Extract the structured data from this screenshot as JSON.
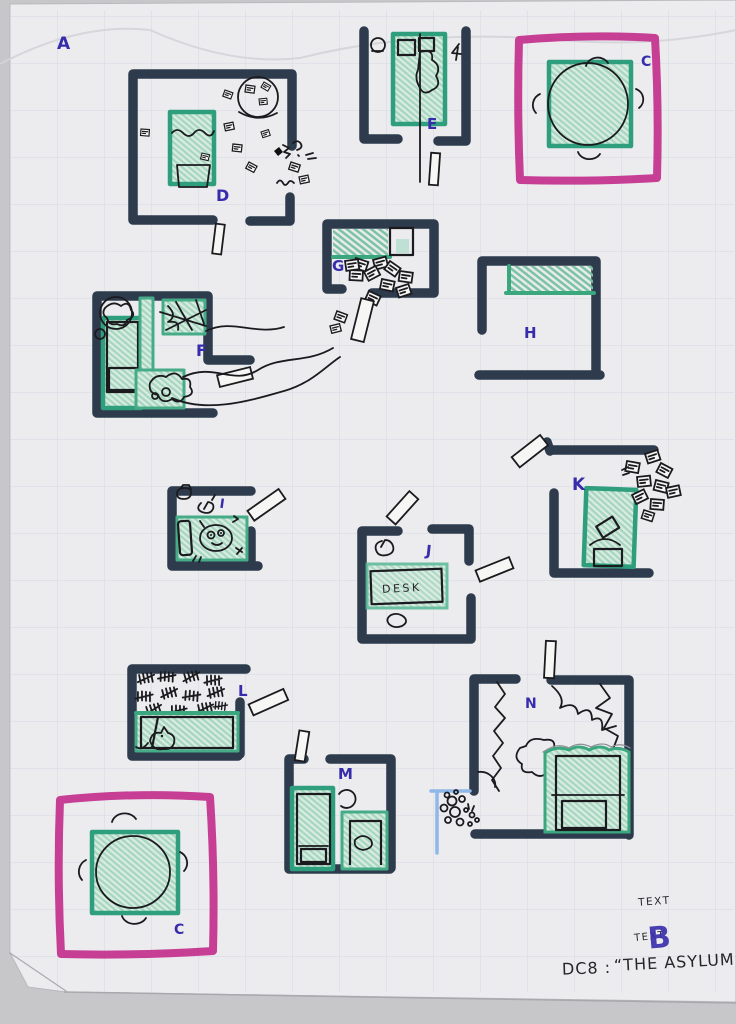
{
  "labels": {
    "a": "A",
    "c_top": "C",
    "d": "D",
    "e": "E",
    "f": "F",
    "g": "G",
    "h": "H",
    "i": "I",
    "j": "J",
    "k": "K",
    "l": "L",
    "m": "M",
    "n": "N",
    "c_bottom": "C"
  },
  "furniture": {
    "desk_label": "DESK"
  },
  "notes": {
    "note_top": "TEXT",
    "note_bottom": "TEXT",
    "overwrite_letter": "B"
  },
  "title": {
    "code": "DC8 :",
    "name": "“THE ASYLUM”"
  },
  "colors": {
    "background": "#c7c7ca",
    "paper": "#ececee",
    "grid": "#c3c8dc",
    "wall_marker": "#2d3b4d",
    "ink": "#1b1b1f",
    "crayon_green": "#2f9e7c",
    "crayon_green_light": "#d9ece2",
    "crayon_pink": "#c4368f",
    "label_blue": "#372cab",
    "secret_passage_blue": "#8fb7e8"
  }
}
